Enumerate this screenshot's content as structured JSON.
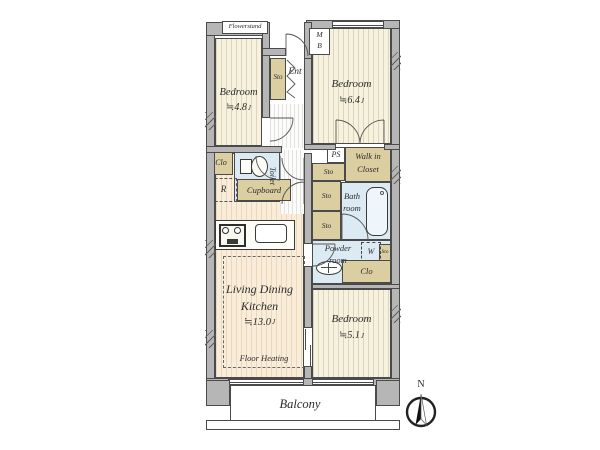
{
  "plan": {
    "north_label": "N",
    "balcony_label": "Balcony",
    "flowerstand_label": "Flowerstand",
    "meter_box": {
      "m": "M",
      "b": "B"
    },
    "entrance_label": "Ent",
    "bedroom_a": {
      "name": "Bedroom",
      "size": "≒4.8",
      "unit": "J"
    },
    "bedroom_b": {
      "name": "Bedroom",
      "size": "≒6.4",
      "unit": "J"
    },
    "bedroom_c": {
      "name": "Bedroom",
      "size": "≒5.1",
      "unit": "J"
    },
    "ldk": {
      "line1": "Living Dining",
      "line2": "Kitchen",
      "size": "≒13.0",
      "unit": "J",
      "floor_note": "Floor Heating"
    },
    "walk_in_closet": {
      "line1": "Walk in",
      "line2": "Closet"
    },
    "bath": {
      "line1": "Bath",
      "line2": "room"
    },
    "powder": {
      "line1": "Powder",
      "line2": "room"
    },
    "toilet_label": "Toilet",
    "cupboard_label": "Cupboard",
    "ps_label": "PS",
    "sto_label": "Sto",
    "clo_label": "Clo",
    "fridge_label": "R",
    "washer_label": "W",
    "colors": {
      "wall": "#b6b6b6",
      "wall_line": "#4a4a4a",
      "bedroom_floor": "#f7f2e0",
      "ldk_floor": "#f9edda",
      "storage": "#dbcfa2",
      "wet_area": "#dcebf3",
      "text": "#2b2b2b"
    }
  }
}
